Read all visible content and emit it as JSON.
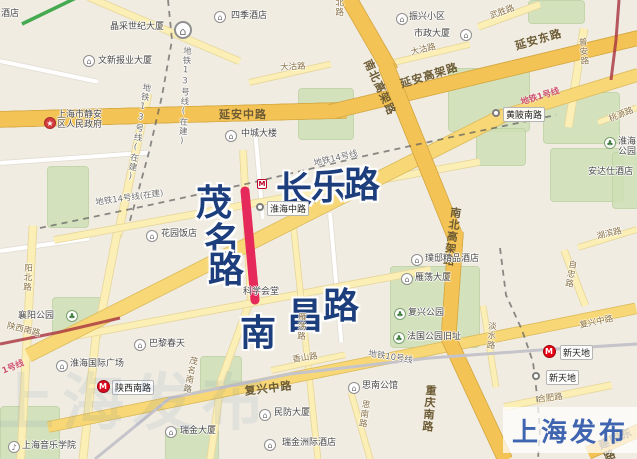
{
  "watermark_badge": {
    "text": "上海发布"
  },
  "faint_watermark": {
    "text": "上海发布"
  },
  "colors": {
    "highlight_red_line": "#e6295b",
    "metro_logo_red": "#e60012",
    "big_road_name_blue": "#1d3e7c",
    "badge_blue": "#3f64b0",
    "main_road_yellow": "#f3c355",
    "park_green": "#cfe0b6",
    "metro_line1_red": "#a8323e",
    "metro_line2_green": "#44a94f"
  },
  "map": {
    "big_name_chars": [
      {
        "c": "茂",
        "x": 196,
        "y": 174
      },
      {
        "c": "名",
        "x": 204,
        "y": 212
      },
      {
        "c": "路",
        "x": 208,
        "y": 241
      },
      {
        "c": "长",
        "x": 276,
        "y": 161
      },
      {
        "c": "乐",
        "x": 311,
        "y": 158
      },
      {
        "c": "路",
        "x": 344,
        "y": 156
      },
      {
        "c": "南",
        "x": 240,
        "y": 304
      },
      {
        "c": "昌",
        "x": 287,
        "y": 287
      },
      {
        "c": "路",
        "x": 323,
        "y": 277
      }
    ],
    "pois": [
      {
        "t": "晶采世纪大厦",
        "lx": 110,
        "ly": 22,
        "g": "⌂",
        "ix": 183,
        "iy": 30,
        "big": 1
      },
      {
        "t": "四季酒店",
        "lx": 231,
        "ly": 11,
        "g": "⌂",
        "ix": 220,
        "iy": 17
      },
      {
        "t": "文新报业大厦",
        "lx": 98,
        "ly": 56,
        "g": "⌂",
        "ix": 89,
        "iy": 61
      },
      {
        "t": "上海市静安\n区人民政府",
        "lx": 57,
        "ly": 110,
        "g": "★",
        "ix": 50,
        "iy": 123,
        "red": 1
      },
      {
        "t": "振兴小区",
        "lx": 409,
        "ly": 12,
        "g": "⌂",
        "ix": 402,
        "iy": 19
      },
      {
        "t": "市政大厦",
        "lx": 414,
        "ly": 29,
        "g": "⌂",
        "ix": 466,
        "iy": 35
      },
      {
        "t": "中城大楼",
        "lx": 241,
        "ly": 129,
        "g": "⌂",
        "ix": 231,
        "iy": 136
      },
      {
        "t": "花园饭店",
        "lx": 161,
        "ly": 229,
        "g": "⌂",
        "ix": 152,
        "iy": 236
      },
      {
        "t": "璞邸精品酒店",
        "lx": 425,
        "ly": 254,
        "g": "⌂",
        "ix": 417,
        "iy": 260
      },
      {
        "t": "雁荡大厦",
        "lx": 415,
        "ly": 273,
        "g": "⌂",
        "ix": 407,
        "iy": 279
      },
      {
        "t": "复兴公园",
        "lx": 408,
        "ly": 308,
        "g": "♣",
        "ix": 400,
        "iy": 314,
        "grn": 1
      },
      {
        "t": "法国公园旧址",
        "lx": 407,
        "ly": 332,
        "g": "♣",
        "ix": 399,
        "iy": 338,
        "grn": 1
      },
      {
        "t": "襄阳公园",
        "lx": 18,
        "ly": 311,
        "g": "♣",
        "ix": 72,
        "iy": 316,
        "grn": 1
      },
      {
        "t": "淮海国际广场",
        "lx": 70,
        "ly": 359,
        "g": "⌂",
        "ix": 62,
        "iy": 366
      },
      {
        "t": "巴黎春天",
        "lx": 149,
        "ly": 339,
        "g": "⌂",
        "ix": 140,
        "iy": 345
      },
      {
        "t": "上海音乐学院",
        "lx": 22,
        "ly": 441,
        "g": "♪",
        "ix": 14,
        "iy": 447
      },
      {
        "t": "瑞金大厦",
        "lx": 180,
        "ly": 426,
        "g": "⌂",
        "ix": 171,
        "iy": 432
      },
      {
        "t": "民防大厦",
        "lx": 274,
        "ly": 408,
        "g": "⌂",
        "ix": 265,
        "iy": 415
      },
      {
        "t": "瑞金洲际酒店",
        "lx": 282,
        "ly": 438,
        "g": "⌂",
        "ix": 270,
        "iy": 445
      },
      {
        "t": "思南公馆",
        "lx": 362,
        "ly": 381,
        "g": "⌂",
        "ix": 354,
        "iy": 388
      },
      {
        "t": "淮海公园",
        "lx": 618,
        "ly": 137,
        "g": "♣",
        "ix": 610,
        "iy": 143,
        "grn": 1
      }
    ],
    "stations": [
      {
        "t": "陕西南路",
        "type": "metro",
        "ix": 103,
        "iy": 386,
        "lx": 112,
        "ly": 380
      },
      {
        "t": "新天地",
        "type": "metro",
        "ix": 549,
        "iy": 351,
        "lx": 560,
        "ly": 345
      },
      {
        "t": "淮海中路",
        "type": "dot",
        "ix": 260,
        "iy": 207,
        "lx": 267,
        "ly": 201
      },
      {
        "t": "新天地",
        "type": "dot",
        "ix": 536,
        "iy": 376,
        "lx": 546,
        "ly": 370
      },
      {
        "t": "黄陂南路",
        "type": "dot",
        "ix": 496,
        "iy": 113,
        "lx": 503,
        "ly": 107
      },
      {
        "t": "M",
        "type": "mini",
        "ix": 262,
        "iy": 184,
        "lx": 0,
        "ly": 0
      }
    ],
    "labels": [
      {
        "t": "延安中路",
        "x": 219,
        "y": 109,
        "r": 0,
        "k": "roadb"
      },
      {
        "t": "延安东路",
        "x": 514,
        "y": 41,
        "r": -16,
        "k": "roadb"
      },
      {
        "t": "延安高架路",
        "x": 399,
        "y": 79,
        "r": -17,
        "k": "roadb"
      },
      {
        "t": "南北高架路",
        "x": 372,
        "y": 58,
        "r": 65,
        "k": "roadb"
      },
      {
        "t": "南北高架路",
        "x": 449,
        "y": 206,
        "r": 8,
        "k": "roadb",
        "v": 1
      },
      {
        "t": "重庆南路",
        "x": 424,
        "y": 384,
        "r": 5,
        "k": "roadb",
        "v": 1
      },
      {
        "t": "建国东路",
        "x": 597,
        "y": 441,
        "r": -24,
        "k": "roadb"
      },
      {
        "t": "复兴中路",
        "x": 244,
        "y": 386,
        "r": -7,
        "k": "roadb"
      },
      {
        "t": "大沽路",
        "x": 280,
        "y": 64,
        "r": -3,
        "k": "road"
      },
      {
        "t": "大沽路",
        "x": 410,
        "y": 49,
        "r": -14,
        "k": "road"
      },
      {
        "t": "武胜路",
        "x": 489,
        "y": 13,
        "r": -20,
        "k": "road"
      },
      {
        "t": "北路",
        "x": 333,
        "y": -2,
        "r": 0,
        "k": "road",
        "v": 1
      },
      {
        "t": "普安路",
        "x": 576,
        "y": 38,
        "r": -5,
        "k": "road",
        "v": 1
      },
      {
        "t": "桃源路",
        "x": 608,
        "y": 116,
        "r": -22,
        "k": "road"
      },
      {
        "t": "湖滨路",
        "x": 596,
        "y": 233,
        "r": -13,
        "k": "road"
      },
      {
        "t": "自忠路",
        "x": 567,
        "y": 259,
        "r": 10,
        "k": "road",
        "v": 1
      },
      {
        "t": "淡水路",
        "x": 486,
        "y": 321,
        "r": 4,
        "k": "road",
        "v": 1
      },
      {
        "t": "雁荡路",
        "x": 296,
        "y": 312,
        "r": 3,
        "k": "road",
        "v": 1
      },
      {
        "t": "茂名南路",
        "x": 188,
        "y": 355,
        "r": 12,
        "k": "road",
        "v": 1
      },
      {
        "t": "阳北路",
        "x": 22,
        "y": 263,
        "r": 3,
        "k": "road",
        "v": 1
      },
      {
        "t": "陕西南路",
        "x": 8,
        "y": 322,
        "r": 14,
        "k": "road"
      },
      {
        "t": "香山路",
        "x": 292,
        "y": 356,
        "r": -8,
        "k": "road"
      },
      {
        "t": "复兴中路",
        "x": 579,
        "y": 322,
        "r": -12,
        "k": "road"
      },
      {
        "t": "思南路",
        "x": 360,
        "y": 399,
        "r": 8,
        "k": "road",
        "v": 1
      },
      {
        "t": "合肥路",
        "x": 537,
        "y": 396,
        "r": -7,
        "k": "road"
      },
      {
        "t": "地铁13号线(在建)",
        "x": 181,
        "y": 46,
        "r": 3,
        "k": "metro",
        "v": 1
      },
      {
        "t": "地铁13号线(在建)",
        "x": 141,
        "y": 82,
        "r": 10,
        "k": "metro",
        "v": 1
      },
      {
        "t": "地铁14号线(在建)",
        "x": 95,
        "y": 199,
        "r": -8,
        "k": "metro"
      },
      {
        "t": "地铁14号线",
        "x": 313,
        "y": 160,
        "r": -13,
        "k": "metro"
      },
      {
        "t": "地铁10号线",
        "x": 369,
        "y": 350,
        "r": 9,
        "k": "metro"
      },
      {
        "t": "地铁1号线",
        "x": 520,
        "y": 99,
        "r": -17,
        "k": "metrored"
      },
      {
        "t": "1号线",
        "x": 1,
        "y": 368,
        "r": -22,
        "k": "metrored"
      },
      {
        "t": "酒店",
        "x": 1,
        "y": 9,
        "r": 0,
        "k": "poi"
      },
      {
        "t": "科学会堂",
        "x": 243,
        "y": 287,
        "r": 0,
        "k": "poi"
      },
      {
        "t": "安达仕酒店",
        "x": 588,
        "y": 167,
        "r": 0,
        "k": "poi"
      }
    ]
  }
}
